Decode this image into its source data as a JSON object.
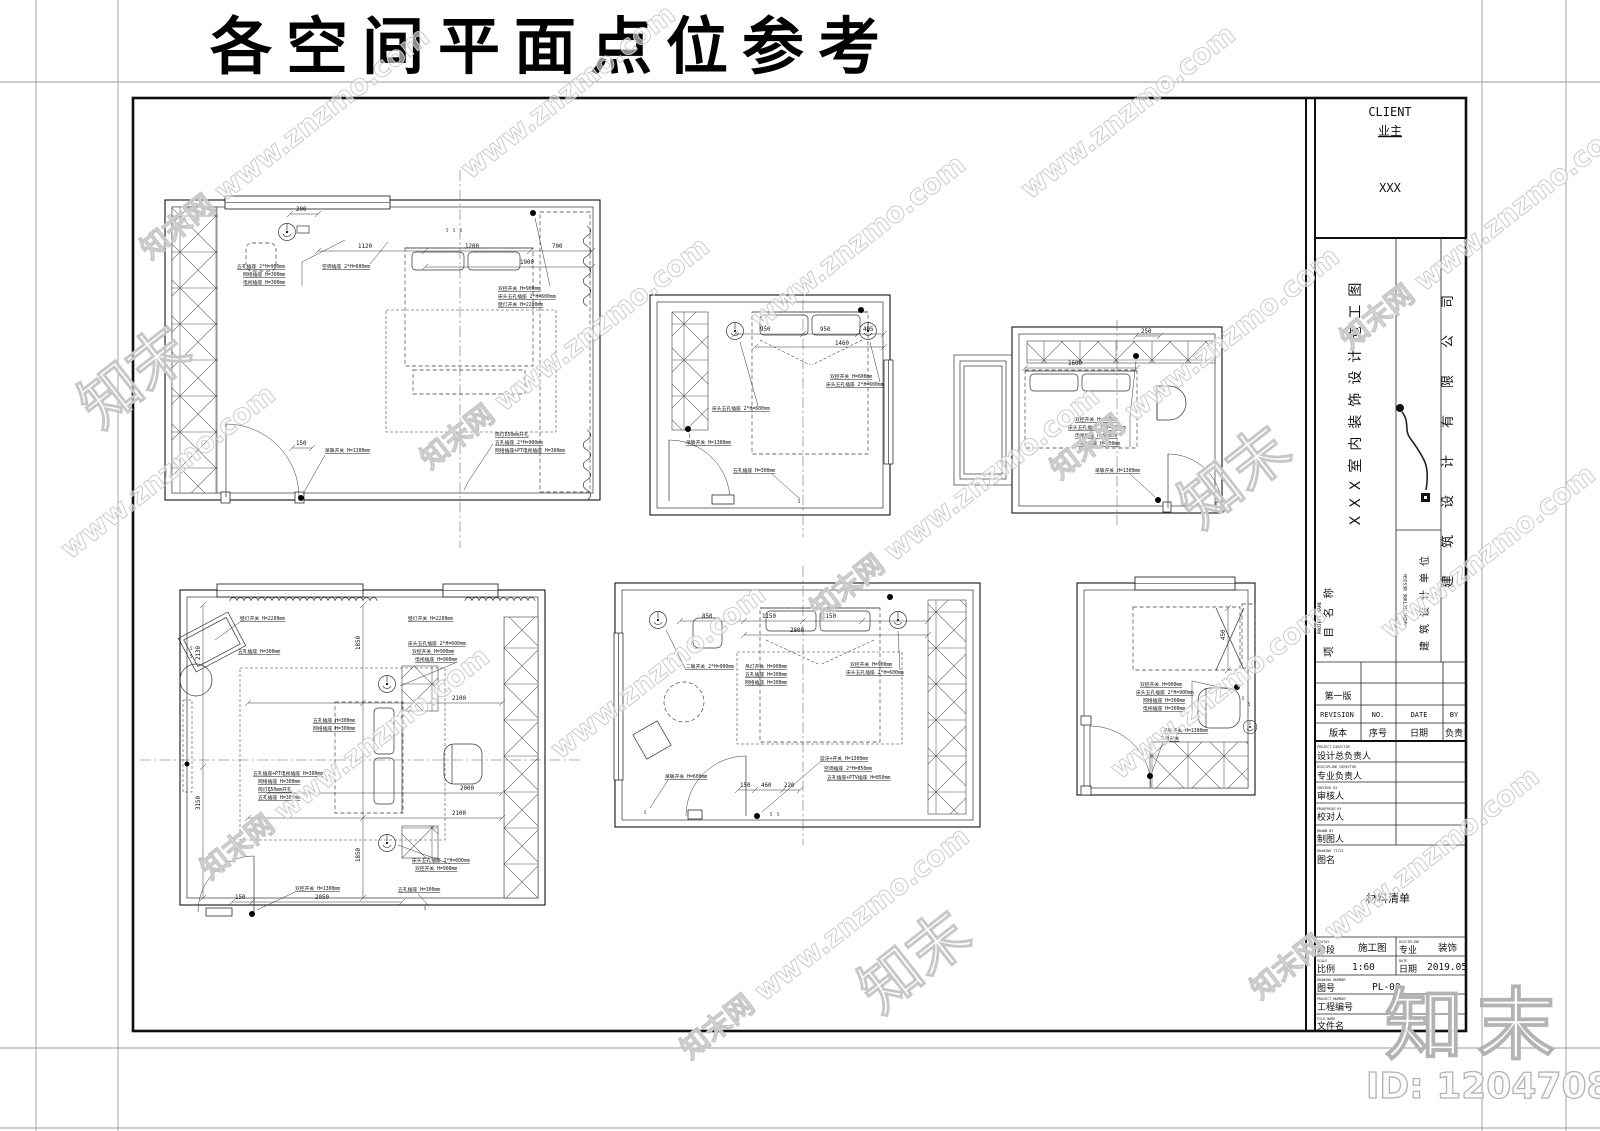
{
  "page_title": "各空间平面点位参考",
  "watermark": {
    "primary": "知末网 www.znzmo.com",
    "secondary": "www.znzmo.com",
    "logo": "知末"
  },
  "branding": {
    "logo_text": "知末",
    "id_text": "ID: 1204708108"
  },
  "title_block": {
    "client_label_en": "CLIENT",
    "client_label_cn": "业主",
    "client_value": "XXX",
    "project_name_label_en": "PROJECT NAME",
    "project_name_label_cn": "项目名称",
    "project_name_value": "XXX室内装饰设计施工图",
    "design_unit_label_en": "ARCHITECTURE DESIGN",
    "design_unit_label_cn": "建筑设计单位",
    "company": "建筑设计有限公司",
    "revision": {
      "first_row": "第一版",
      "header_en": [
        "REVISION",
        "NO.",
        "DATE",
        "BY"
      ],
      "header_cn": [
        "版本",
        "序号",
        "日期",
        "负责"
      ]
    },
    "fields": [
      {
        "en": "PROJECT DIRECTOR",
        "cn": "设计总负责人",
        "value": ""
      },
      {
        "en": "DISCIPLINE DIRECTOR",
        "cn": "专业负责人",
        "value": ""
      },
      {
        "en": "CHECKED BY",
        "cn": "审核人",
        "value": ""
      },
      {
        "en": "PROOFREAD BY",
        "cn": "校对人",
        "value": ""
      },
      {
        "en": "DRAWN BY",
        "cn": "制图人",
        "value": ""
      }
    ],
    "drawing_title": {
      "en": "DRAWING TITLE",
      "cn": "图名",
      "value": "材料清单"
    },
    "footer": {
      "stage": {
        "en": "STATUS",
        "cn": "阶段",
        "value": "施工图"
      },
      "discipline": {
        "en": "DISCIPLINE",
        "cn": "专业",
        "value": "装饰"
      },
      "scale": {
        "en": "SCALE",
        "cn": "比例",
        "value": "1:60"
      },
      "date": {
        "en": "DATE",
        "cn": "日期",
        "value": "2019.05"
      },
      "drawing_no": {
        "en": "DRAWING NUMBER",
        "cn": "图号",
        "value": "PL-00"
      },
      "project_no": {
        "en": "PROJECT NUMBER",
        "cn": "工程编号",
        "value": ""
      },
      "file_name": {
        "en": "FILE NAME",
        "cn": "文件名",
        "value": ""
      }
    }
  },
  "plans": [
    {
      "name": "bedroom-plan-1",
      "labels": [
        "五孔插座 2*H=900mm",
        "网络插座 H=300mm",
        "电视插座 H=300mm",
        "空调插座 2*H=600mm",
        "双控开关 H=900mm",
        "床头五孔插座 2*H=600mm",
        "壁灯开关 H=2200mm",
        "筒灯D50mm开孔",
        "五孔插座 2*H=900mm",
        "网络插座+PT电视插座 H=300mm",
        "单联开关 H=1300mm"
      ],
      "dims": [
        "200",
        "1120",
        "1200",
        "700",
        "1900",
        "150"
      ]
    },
    {
      "name": "bedroom-plan-2",
      "labels": [
        "床头五孔插座 2*H=600mm",
        "双控开关 H=600mm",
        "床头五孔插座 2*H=600mm",
        "单联开关 H=1300mm",
        "五孔插座 H=300mm"
      ],
      "dims": [
        "950",
        "950",
        "405",
        "1460"
      ]
    },
    {
      "name": "bedroom-plan-3",
      "labels": [
        "双控开关 H=900mm",
        "床头五孔插座 2*H=900mm",
        "电视插座 H=900mm",
        "网络插座 H=300mm",
        "单联开关 H=1300mm"
      ],
      "dims": [
        "250",
        "1600"
      ]
    },
    {
      "name": "bedroom-plan-4",
      "labels": [
        "壁灯开关 H=2200mm",
        "五孔插座 H=300mm",
        "壁灯开关 H=2200mm",
        "床头五孔插座 2*H=600mm",
        "双控开关 H=900mm",
        "电视插座 H=900mm",
        "五孔插座 H=300mm",
        "网络插座 H=300mm",
        "五孔插座+PT电视插座 H=300mm",
        "网络插座 H=300mm",
        "筒灯D50mm开孔",
        "五孔插座 H=300mm",
        "床头五孔插座 2*H=600mm",
        "双控开关 H=900mm",
        "双控开关 H=1300mm",
        "五孔插座 H=300mm"
      ],
      "dims": [
        "2130",
        "3150",
        "1850",
        "1850",
        "2100",
        "2000",
        "2100",
        "150",
        "2050"
      ]
    },
    {
      "name": "bedroom-plan-5",
      "labels": [
        "二联开关 2*H=900mm",
        "吊灯开关 H=900mm",
        "五孔插座 H=300mm",
        "网络插座 H=300mm",
        "双控开关 H=900mm",
        "床头五孔插座 2*H=600mm",
        "单联开关 H=600mm",
        "蓝牙+开关 H=1300mm",
        "空调插座 2*H=850mm",
        "五孔插座+PTV插座 H=850mm"
      ],
      "dims": [
        "850",
        "1150",
        "1150",
        "2800",
        "150",
        "460",
        "220"
      ]
    },
    {
      "name": "study-plan-6",
      "labels": [
        "双控开关 H=900mm",
        "床头五孔插座 2*H=900mm",
        "网络插座 H=300mm",
        "电视插座 H=300mm",
        "单联开关 H=1300mm",
        "二联开关"
      ],
      "dims": [
        "450"
      ]
    }
  ]
}
